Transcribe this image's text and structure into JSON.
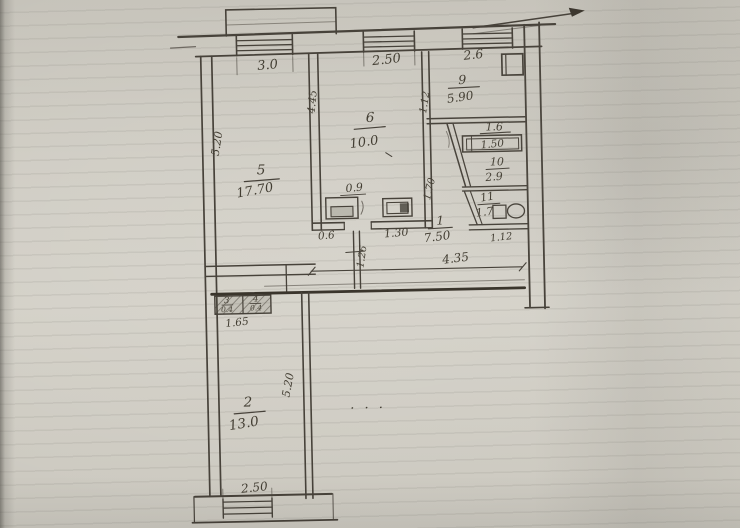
{
  "plan": {
    "rooms": {
      "hall": {
        "num": "1",
        "area": "7.50"
      },
      "room2": {
        "num": "2",
        "area": "13.0"
      },
      "closet3": {
        "num": "3",
        "area": "0.4"
      },
      "closet4": {
        "num": "4",
        "area": "0.4"
      },
      "room5": {
        "num": "5",
        "area": "17.70"
      },
      "kitchen6": {
        "num": "6",
        "area": "10.0"
      },
      "room9": {
        "num": "9",
        "area": "5.90"
      },
      "bath10": {
        "num": "10",
        "area": "2.9"
      },
      "wc11": {
        "num": "11",
        "area": "1.7"
      }
    },
    "dimensions": {
      "window_left": "3.0",
      "window_mid": "2.50",
      "window_right": "2.6",
      "bath_width": "1.6",
      "bathtub": "1.50",
      "wc_width": "1.12",
      "v_112": "1.12",
      "v_170": "1.70",
      "kitchen_side": "4.45",
      "kitchen_door": "0.9",
      "d_06": "0.6",
      "d_130": "1.30",
      "v_126": "1.26",
      "hall_width": "4.35",
      "room5_side": "5.20",
      "room2_side": "5.20",
      "closets_width": "1.65",
      "window_bottom": "2.50",
      "dots": "· · ·"
    },
    "colors": {
      "paper": "#cecbc2",
      "ink": "#47423a",
      "ink_dark": "#3a352c",
      "paper_edge": "#85827a"
    }
  }
}
